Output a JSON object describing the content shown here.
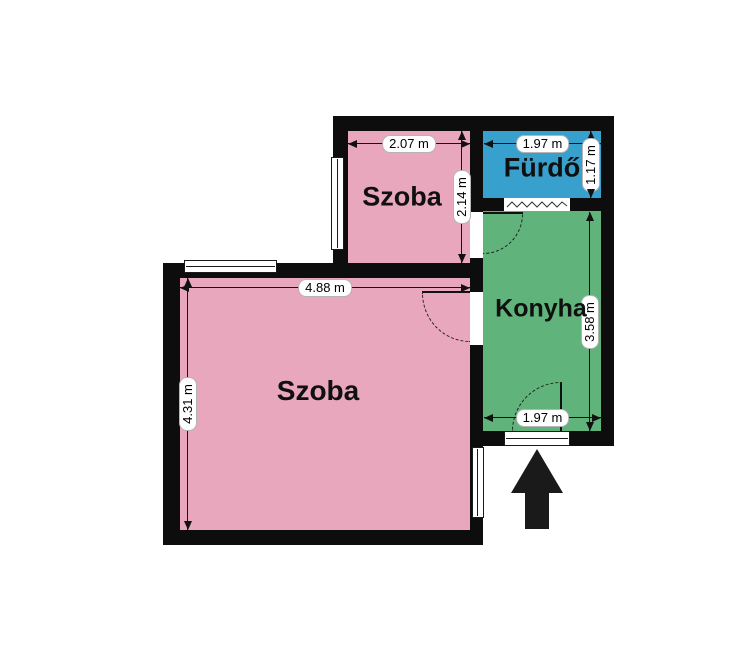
{
  "floorplan": {
    "background_color": "#ffffff",
    "wall_color": "#0d0d0d",
    "rooms": [
      {
        "name": "Szoba",
        "width_label": "2.07 m",
        "height_label": "2.14 m",
        "color": "#e8a7bd"
      },
      {
        "name": "Fürdő",
        "width_label": "1.97 m",
        "height_label": "1.17 m",
        "color": "#38a0cd"
      },
      {
        "name": "Konyha",
        "width_label": "1.97 m",
        "height_label": "3.58 m",
        "color": "#5fb37b"
      },
      {
        "name": "Szoba",
        "width_label": "4.88 m",
        "height_label": "4.31 m",
        "color": "#e8a7bd"
      }
    ],
    "entrance": {
      "icon": "up-arrow",
      "color": "#1a1a1a"
    },
    "symbols": {
      "vent_window": "zigzag-glass",
      "door_swing": "dashed-quarter-arc",
      "window": "double-line-rect"
    }
  }
}
